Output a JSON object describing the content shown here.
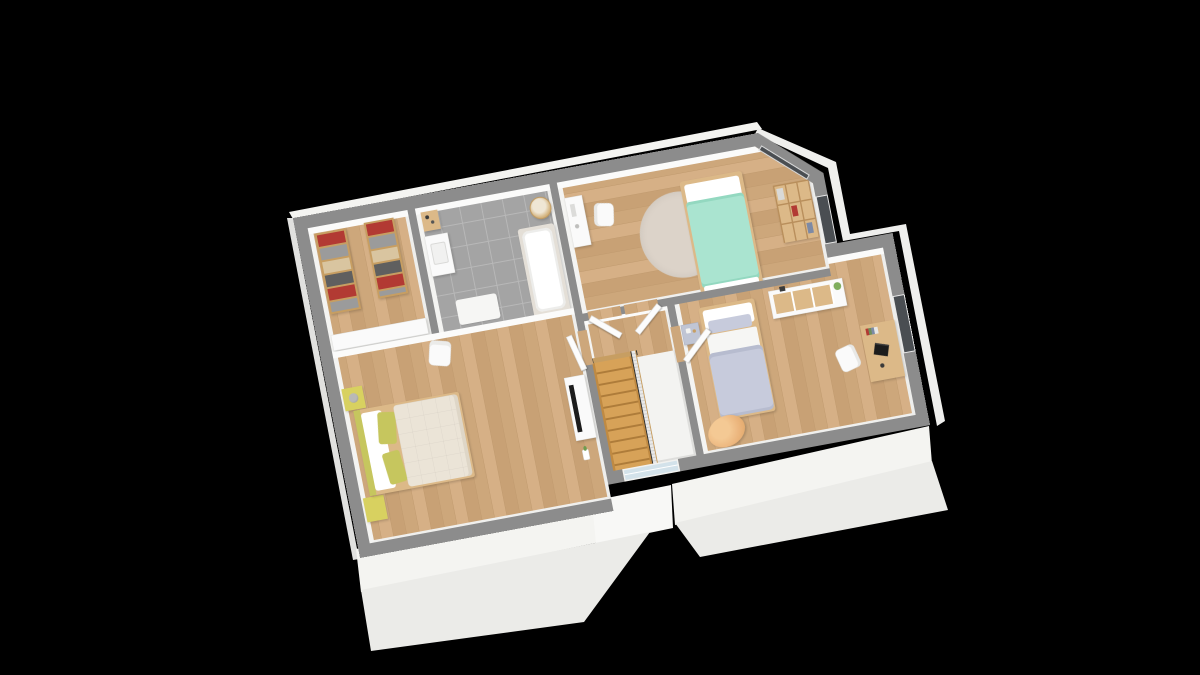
{
  "scene": {
    "kind": "3d-floorplan-render",
    "description": "Isometric 3D cutaway floor plan of an upper storey on a black background",
    "background": "#000000"
  },
  "palette": {
    "wall": "#8c8c8c",
    "wallFaceN": "#fbfbfa",
    "wallFaceW": "#f4f4f2",
    "wallFaceE": "#eeeeec",
    "wallFaceS": "#f0f0ee",
    "wood": "#cda77b",
    "wood2": "#c09a6e",
    "wood3": "#d6b086",
    "tile": "#a4a4a4",
    "tileLine": "#b8b8b8",
    "white": "#fafafa",
    "mint": "#aae4d0",
    "mintDark": "#93d8c0",
    "lavender": "#c7cbdc",
    "cream": "#ebe4d7",
    "yellow": "#d8d160",
    "pillowGreen": "#c6c65e",
    "beanbag": "#ecb67e",
    "rug": "#dcd3c9",
    "woodFurn": "#dcb988",
    "woodFrame": "#c79e62",
    "stair": "#d7a258",
    "stairGap": "#ae7c3a",
    "glass": "#d3e2ea",
    "clothRed": "#b23a33",
    "clothGray": "#9b9b9b",
    "clothTan": "#d9c5a0",
    "clothDark": "#5f5f5f",
    "dark": "#1c1c1c",
    "winFrame": "#e9e9e9",
    "winDark": "#4a4e52",
    "ext": "#f4f4f1",
    "extShade": "#ebebe8"
  },
  "projection": {
    "plan_size": [
      1240,
      710
    ],
    "correspondences": {
      "plan": [
        [
          0,
          0
        ],
        [
          1000,
          0
        ],
        [
          0,
          710
        ],
        [
          1240,
          655
        ]
      ],
      "screen": [
        [
          293,
          218
        ],
        [
          758,
          133
        ],
        [
          360,
          558
        ],
        [
          930,
          425
        ]
      ]
    }
  },
  "rooms": [
    {
      "id": "closet",
      "floor": "wood",
      "furniture": [
        "clothes-rack",
        "clothes-rack",
        "sideboard"
      ]
    },
    {
      "id": "bathroom",
      "floor": "tile",
      "furniture": [
        "side-table",
        "sink-cabinet",
        "laundry-basket",
        "bathtub",
        "bath-mat"
      ]
    },
    {
      "id": "bedroom-1",
      "floor": "wood",
      "furniture": [
        "vanity-desk",
        "chair",
        "round-rug",
        "single-bed-mint",
        "cube-bookshelf"
      ]
    },
    {
      "id": "bedroom-2",
      "floor": "wood",
      "furniture": [
        "nightstand",
        "single-bed-lavender",
        "dresser",
        "plant",
        "desk",
        "laptop",
        "chair",
        "beanbag"
      ]
    },
    {
      "id": "master-bedroom",
      "floor": "wood",
      "furniture": [
        "double-bed",
        "nightstand-yellow",
        "lamp",
        "nightstand-yellow",
        "armchair",
        "tv-console",
        "tv",
        "flower-vase"
      ]
    },
    {
      "id": "stair-hall",
      "floor": "wood",
      "furniture": [
        "staircase",
        "stair-railing",
        "landing-void"
      ]
    }
  ],
  "openings": {
    "doors": [
      "bathroom-door",
      "bedroom-1-door",
      "master-bedroom-door",
      "bedroom-2-door"
    ],
    "windows": [
      "chamfer-window",
      "bedroom-1-east-window",
      "bedroom-2-east-window",
      "landing-window"
    ]
  }
}
